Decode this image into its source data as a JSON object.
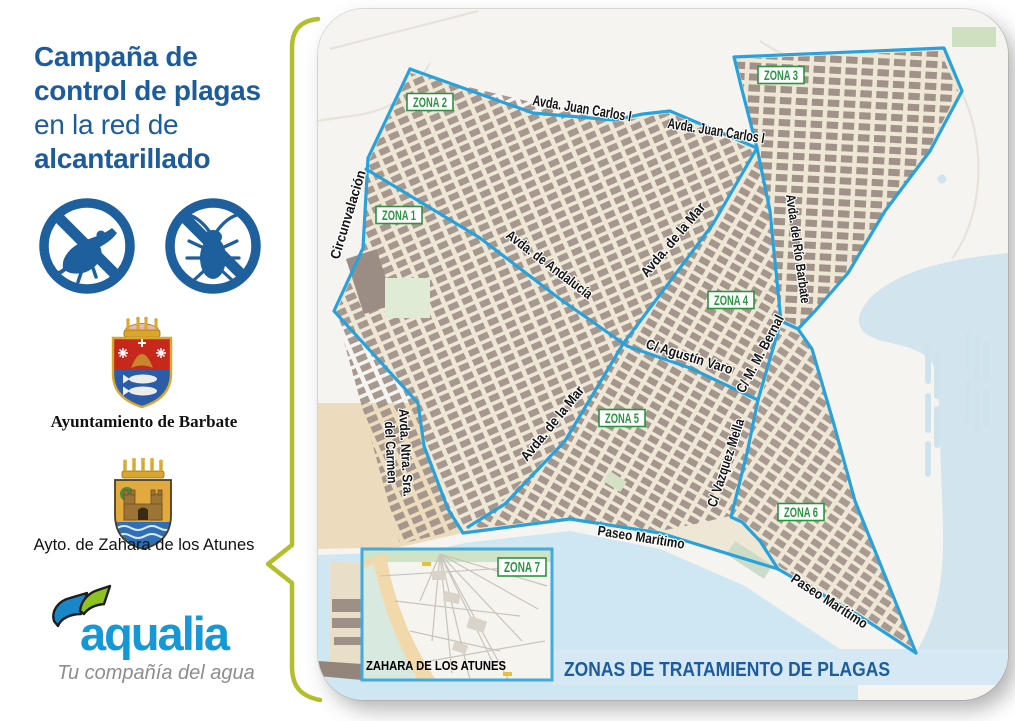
{
  "campaign": {
    "title_lines": [
      "Campaña de",
      "control de plagas",
      "en la red de",
      "alcantarillado"
    ]
  },
  "orgs": {
    "barbate_caption": "Ayuntamiento de Barbate",
    "zahara_caption": "Ayto. de Zahara de los Atunes"
  },
  "aqualia": {
    "wordmark": "aqualia",
    "tagline": "Tu compañía del agua"
  },
  "map": {
    "banner": "ZONAS DE TRATAMIENTO DE PLAGAS",
    "zones": [
      "ZONA 1",
      "ZONA 2",
      "ZONA 3",
      "ZONA 4",
      "ZONA 5",
      "ZONA 6",
      "ZONA 7"
    ],
    "streets": {
      "juan_carlos_a": "Avda. Juan Carlos I",
      "juan_carlos_b": "Avda. Juan Carlos I",
      "circunvalacion": "Circunvalación",
      "andalucia": "Avda. de Andalucía",
      "mar_upper": "Avda. de la Mar",
      "mar_lower": "Avda. de la Mar",
      "rio_barbate": "Avda. del Río Barbate",
      "agustin_varo": "C/ Agustín Varo",
      "mm_bernal": "C/ M. M. Bernal",
      "vazquez_mella": "C/ Vazquez Mella",
      "carmen_a": "Avda.  Ntra.  Sra.",
      "carmen_b": "del Carmen",
      "paseo_a": "Paseo Marítimo",
      "paseo_b": "Paseo Marítimo"
    },
    "inset_caption": "ZAHARA DE LOS ATUNES"
  },
  "colors": {
    "brand_blue": "#1d5c9c",
    "zone_line_blue": "#29a2db",
    "zone_label_green": "#2a9440",
    "brace_green": "#b2bf2b",
    "water": "#d2e5ef",
    "banner_bg": "#d5e8f4",
    "aqualia_blue": "#1598d5",
    "aqualia_green": "#8dc21f"
  }
}
